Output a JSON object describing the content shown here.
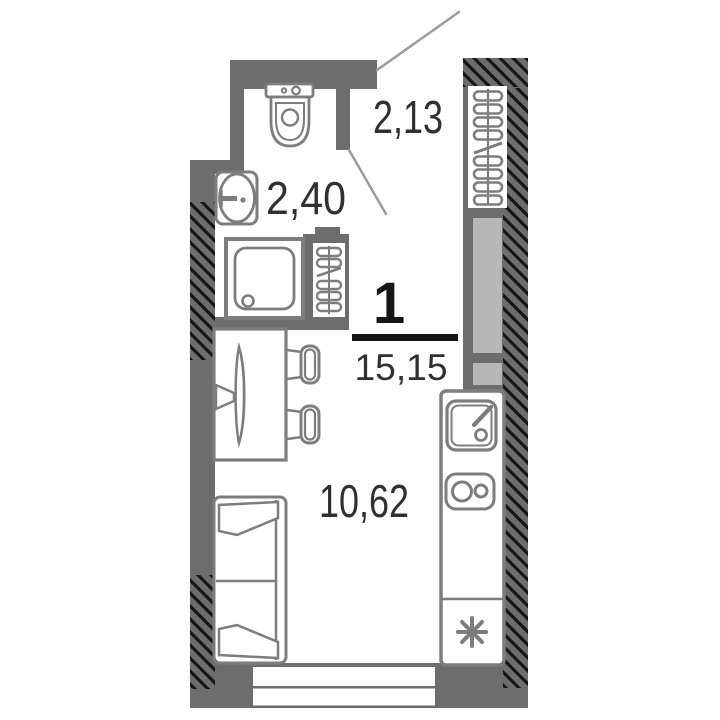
{
  "plan_info": {
    "rooms_count": "1",
    "total_area": "15,15"
  },
  "labels": {
    "hallway_area": "2,13",
    "bathroom_area": "2,40",
    "living_area": "10,62"
  },
  "symbols": {
    "asterisk": "washing-machine-outlet"
  },
  "colors": {
    "wall": "#6d6d6d",
    "furn": "#7d7d7d",
    "shaft": "#b7b7b7",
    "hatch": "#161616",
    "text": "#303030",
    "marker": "#161616",
    "leader": "#9c9c9c",
    "bg": "#ffffff"
  }
}
